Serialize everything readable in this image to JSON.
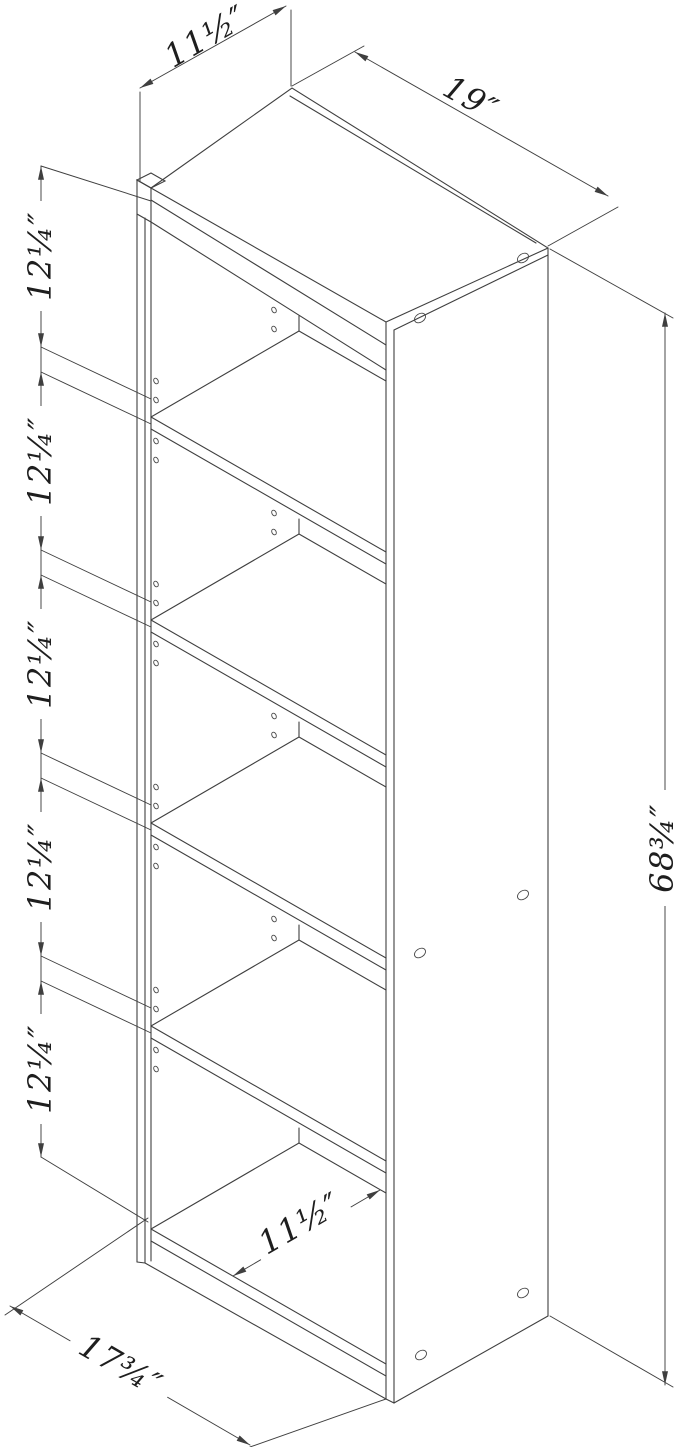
{
  "diagram": {
    "dimensions": {
      "top_depth_label": "11½″",
      "top_width_label": "19″",
      "overall_height_label": "68¾″",
      "shelf_spacing_labels": [
        "12¼″",
        "12¼″",
        "12¼″",
        "12¼″",
        "12¼″"
      ],
      "interior_depth_label": "11½″",
      "base_width_label": "17¾″"
    }
  }
}
